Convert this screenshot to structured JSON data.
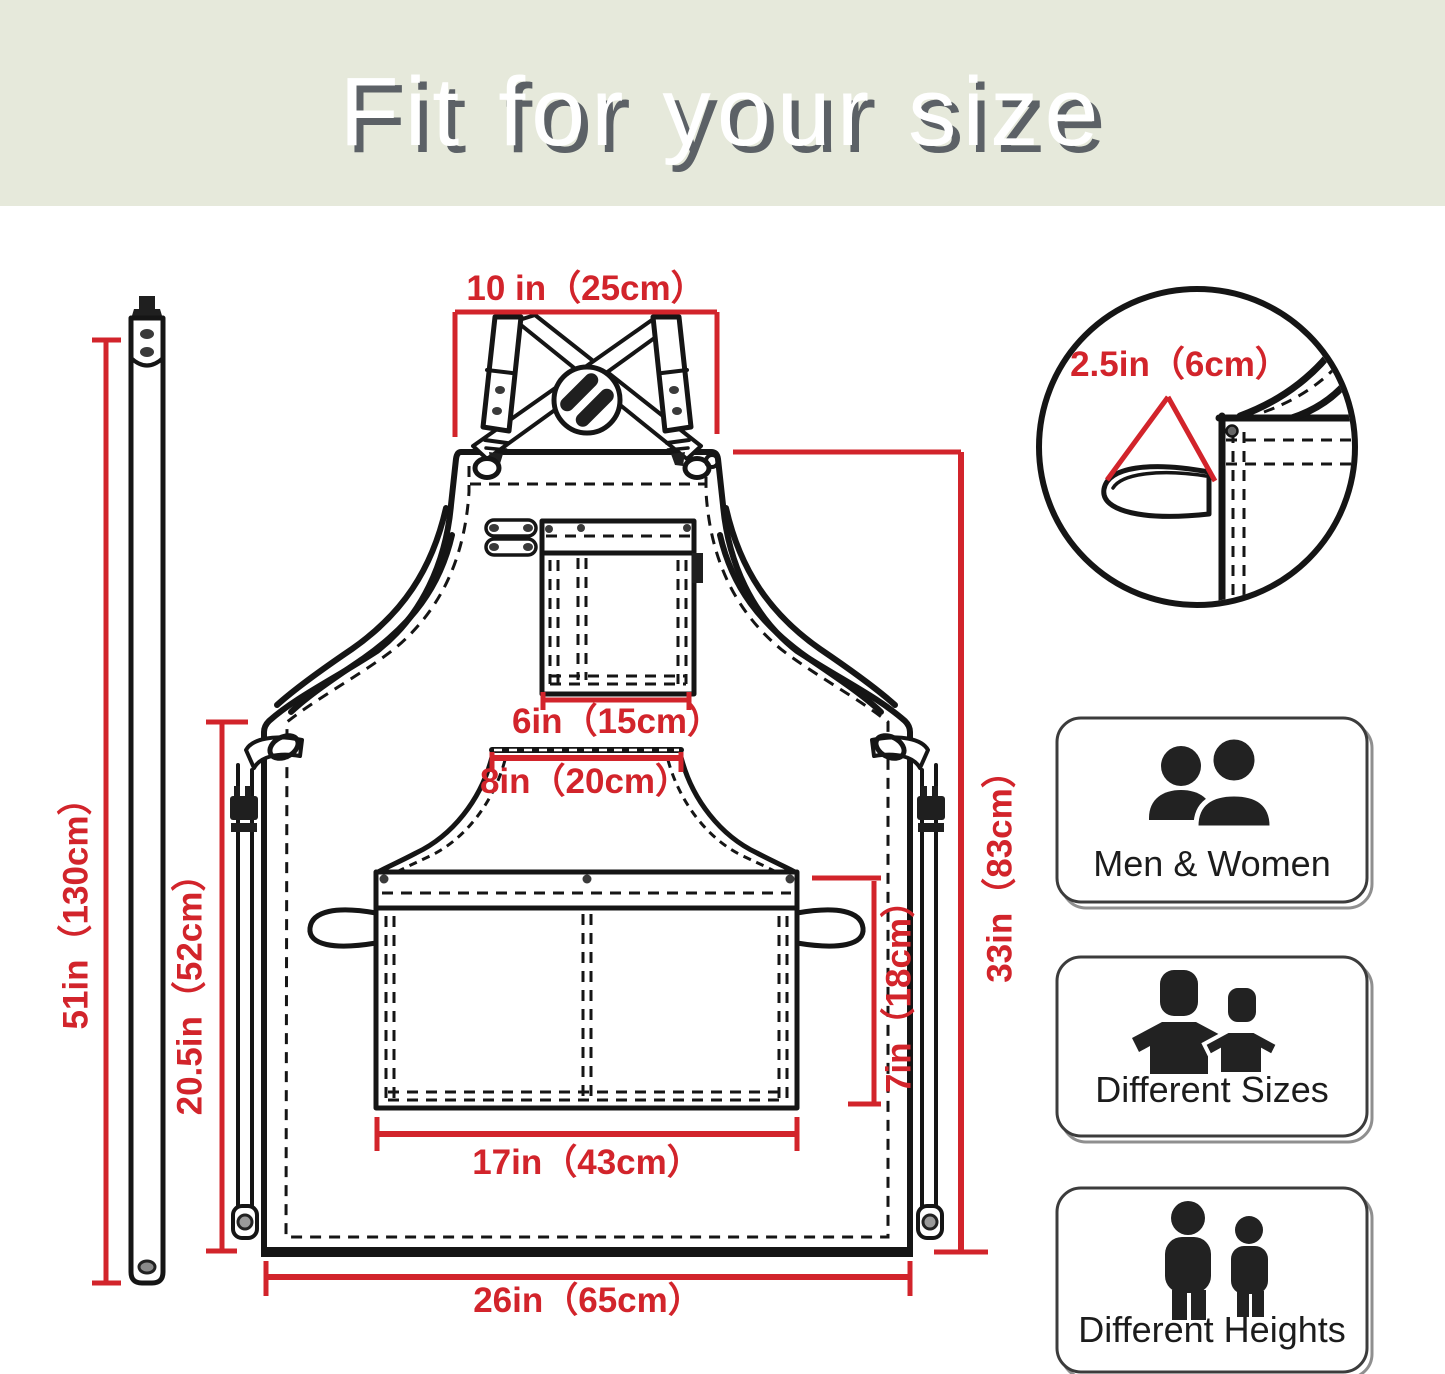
{
  "header": {
    "title": "Fit for your size"
  },
  "colors": {
    "accent_red": "#d2242b",
    "line_black": "#151515",
    "header_bg": "#e6e9db",
    "header_text": "#ffffff",
    "header_shadow": "#5c6166"
  },
  "diagram": {
    "dimensions": {
      "neck_strap_width": "10 in（25cm）",
      "strap_length": "51in（130cm）",
      "side_length": "20.5in（52cm）",
      "chest_pocket_width": "6in（15cm）",
      "waist_seam_width": "8in（20cm）",
      "front_pocket_width": "17in（43cm）",
      "front_pocket_height": "7in（18cm）",
      "apron_length": "33in（83cm）",
      "apron_width": "26in（65cm）",
      "side_loop_width": "2.5in（6cm）"
    }
  },
  "features": [
    {
      "label": "Men & Women",
      "icon": "men-women-icon"
    },
    {
      "label": "Different Sizes",
      "icon": "different-sizes-icon"
    },
    {
      "label": "Different Heights",
      "icon": "different-heights-icon"
    }
  ]
}
